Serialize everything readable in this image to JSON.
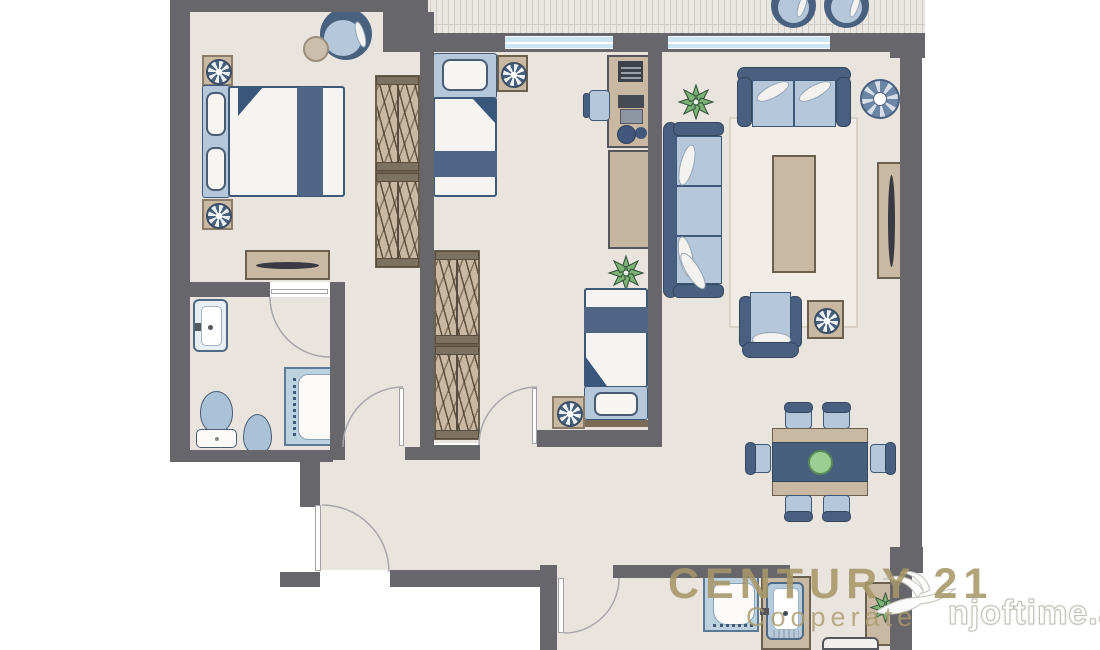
{
  "watermarks": {
    "brand": "CENTURY 21",
    "tagline": "Cooperate",
    "site": "njoftime.al"
  },
  "palette": {
    "wall": "#67676b",
    "floor": "#eae4de",
    "balcony_deck": "#eae6e2",
    "furniture_dark_blue": "#4a6080",
    "furniture_light_blue": "#b5c7da",
    "upholstery_white": "#f6f4f0",
    "wood_beige": "#c9b9a2",
    "wood_dark": "#6b5f4e",
    "window_blue": "#cde6f2",
    "plant_green": "#7db377",
    "bowl_green": "#9ccd92",
    "watermark_gold": "#b0a176",
    "watermark_site_outline": "#c2bdb7"
  },
  "floorplan": {
    "type": "apartment-floor-plan-2-bedrooms",
    "rooms": [
      {
        "name": "bedroom-1",
        "furniture": [
          "double-bed",
          "nightstand",
          "nightstand",
          "round-armchair",
          "round-side-table",
          "sideboard",
          "wardrobe",
          "wardrobe"
        ]
      },
      {
        "name": "bathroom",
        "furniture": [
          "wash-basin",
          "toilet",
          "bidet",
          "shower"
        ]
      },
      {
        "name": "bedroom-2",
        "furniture": [
          "single-bed",
          "single-bed",
          "desk",
          "desk-chair",
          "stool",
          "bookcase",
          "wardrobe",
          "wardrobe",
          "nightstand",
          "corner-table",
          "plant"
        ]
      },
      {
        "name": "living-dining-room",
        "furniture": [
          "two-seat-sofa",
          "three-seat-sofa",
          "armchair",
          "rug",
          "coffee-table",
          "tv-unit",
          "side-table",
          "round-decor",
          "plant",
          "dining-table",
          "dining-chair",
          "dining-chair",
          "dining-chair",
          "dining-chair",
          "dining-chair",
          "dining-chair"
        ]
      },
      {
        "name": "hallway",
        "furniture": []
      },
      {
        "name": "second-bathroom",
        "furniture": [
          "shower",
          "wash-basin-counter",
          "cabinet-with-plant",
          "washing-machine"
        ]
      },
      {
        "name": "balcony",
        "furniture": [
          "round-chair",
          "round-chair"
        ]
      }
    ],
    "doors": 5,
    "windows": 2
  }
}
